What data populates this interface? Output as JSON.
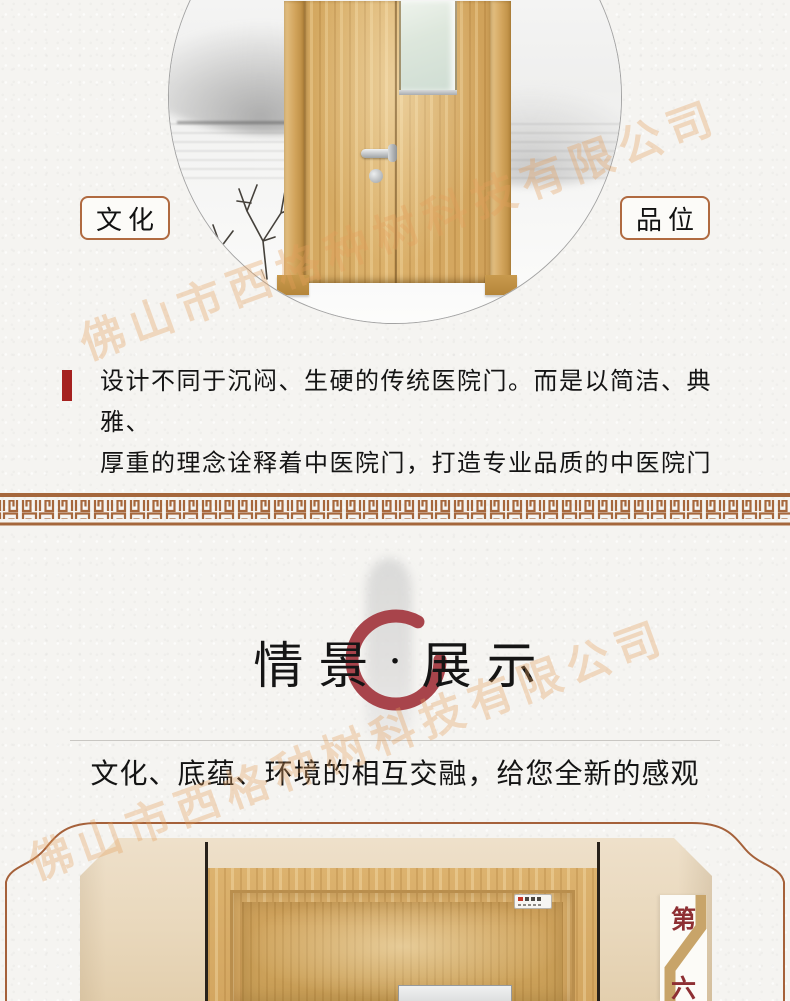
{
  "colors": {
    "paper": "#f5f4f1",
    "border_brown": "#a5673c",
    "tag_border": "#b06a40",
    "red_bar": "#a5211f",
    "enso_red": "#a8444b",
    "badge_red": "#8e2f33",
    "ribbon_tan": "#c8a469",
    "wood": "#d7ab64",
    "wall_beige": "#ead9bf",
    "ink": "#1c1c1c"
  },
  "hero": {
    "tag_left": "文化",
    "tag_right": "品位",
    "desc_line1": "设计不同于沉闷、生硬的传统医院门。而是以简洁、典雅、",
    "desc_line2": "厚重的理念诠释着中医院门，打造专业品质的中医院门"
  },
  "display": {
    "title_parts": [
      "情",
      "景",
      "·",
      "展",
      "示"
    ],
    "subtitle": "文化、底蕴、环境的相互交融，给您全新的感观"
  },
  "showcase": {
    "badge_top": "第",
    "badge_bottom": "六"
  },
  "watermark": {
    "text": "佛山市西格种树科技有限公司"
  }
}
